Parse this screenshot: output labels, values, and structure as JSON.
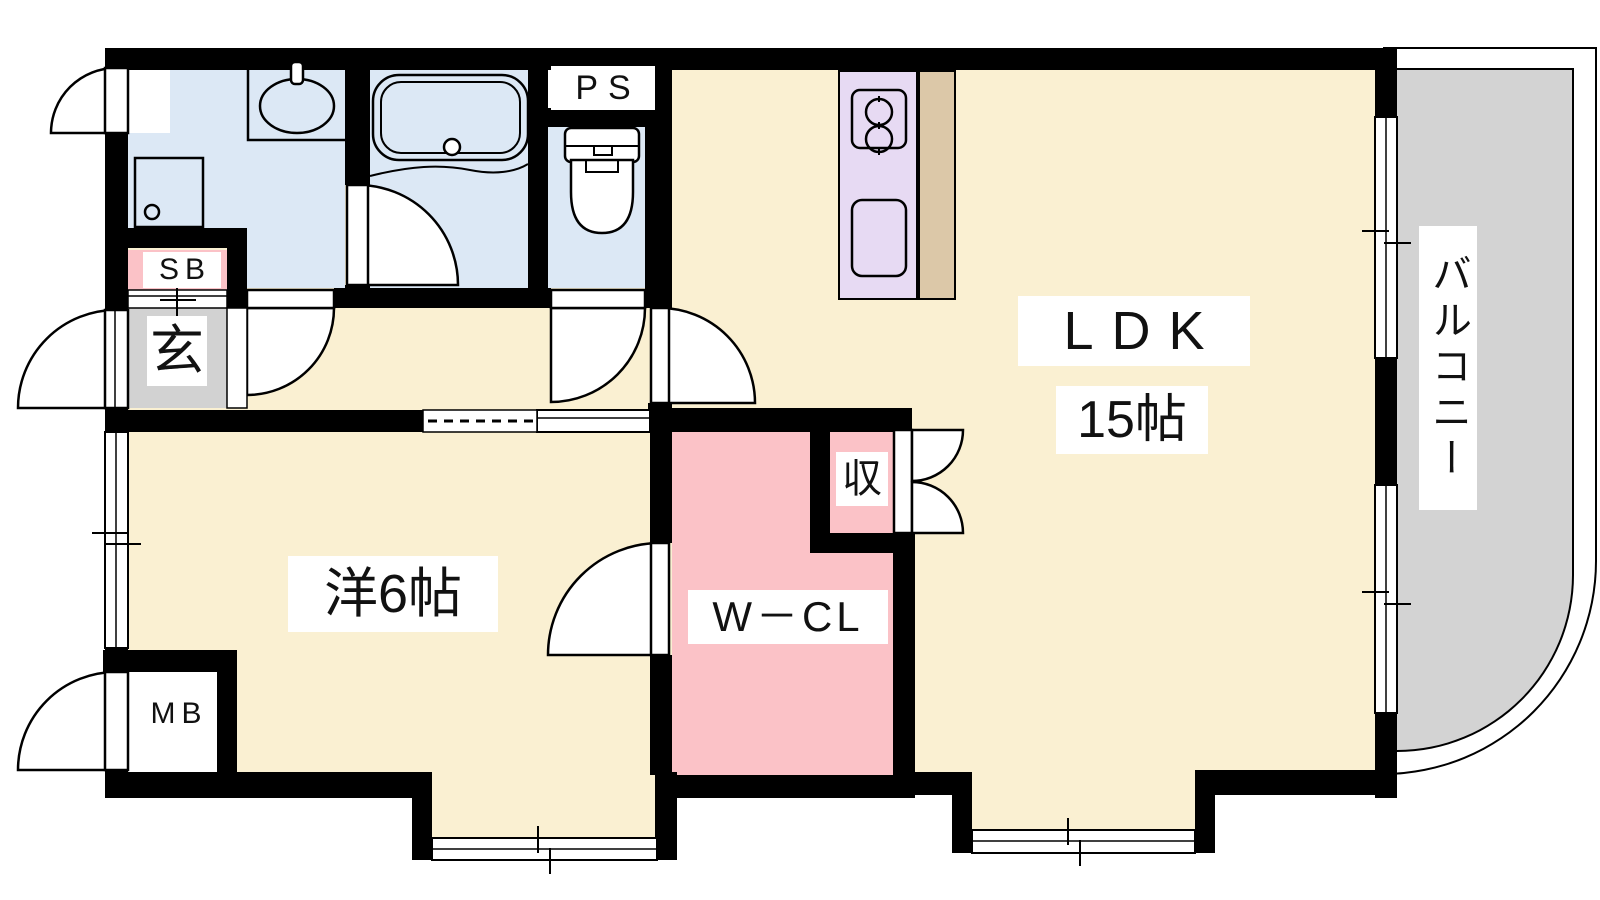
{
  "colors": {
    "bg": "#FFFFFF",
    "wall": "#000000",
    "floor": "#FAF0D2",
    "wet": "#DCE8F5",
    "pink": "#FBC2C7",
    "kitchen": "#E7DAF3",
    "counter_tan": "#DCC8A8",
    "balcony_gray": "#D3D3D3",
    "genkan_gray": "#D2D2D2"
  },
  "labels": {
    "ldk": "LDK",
    "ldk_size": "15帖",
    "western_room": "洋6帖",
    "walk_in_closet": "W－CL",
    "storage": "収",
    "balcony": "バルコニー",
    "entrance": "玄",
    "shoe_box": "SB",
    "meter_box": "MB",
    "pipe_space": "PS"
  }
}
